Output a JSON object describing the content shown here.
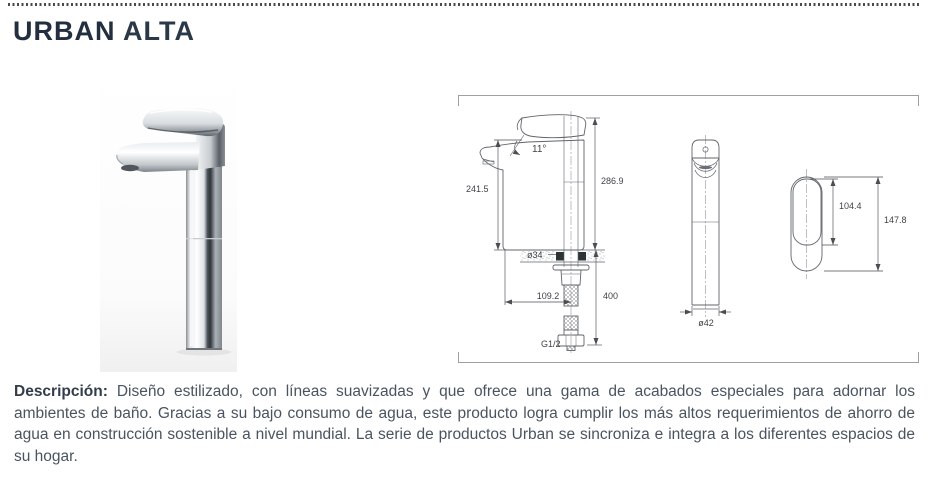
{
  "header": {
    "title_primary": "URBAN",
    "title_secondary": "ALTA"
  },
  "technical_drawing": {
    "side_view": {
      "body_height": "241.5",
      "handle_angle": "11°",
      "overall_height": "286.9",
      "mount_hole_diameter": "ø34",
      "hose_offset": "109.2",
      "hose_length": "400",
      "thread_size": "G1/2"
    },
    "front_view": {
      "base_diameter": "ø42"
    },
    "handle_top_view": {
      "lever_length": "104.4",
      "overall_length": "147.8"
    }
  },
  "description": {
    "label": "Descripción:",
    "body": "Diseño estilizado, con líneas suavizadas y que ofrece una gama de acabados especiales para adornar los ambientes de baño. Gracias a su bajo consumo de agua, este producto logra cumplir los más altos requerimientos de ahorro de agua en construcción sostenible a nivel mundial. La serie de productos Urban se sincroniza e integra a los diferentes espacios de su hogar."
  },
  "colors": {
    "title": "#232f3e",
    "body_text": "#4a5460",
    "drawing_lines": "#60656a",
    "rule_dots": "#464b52"
  }
}
